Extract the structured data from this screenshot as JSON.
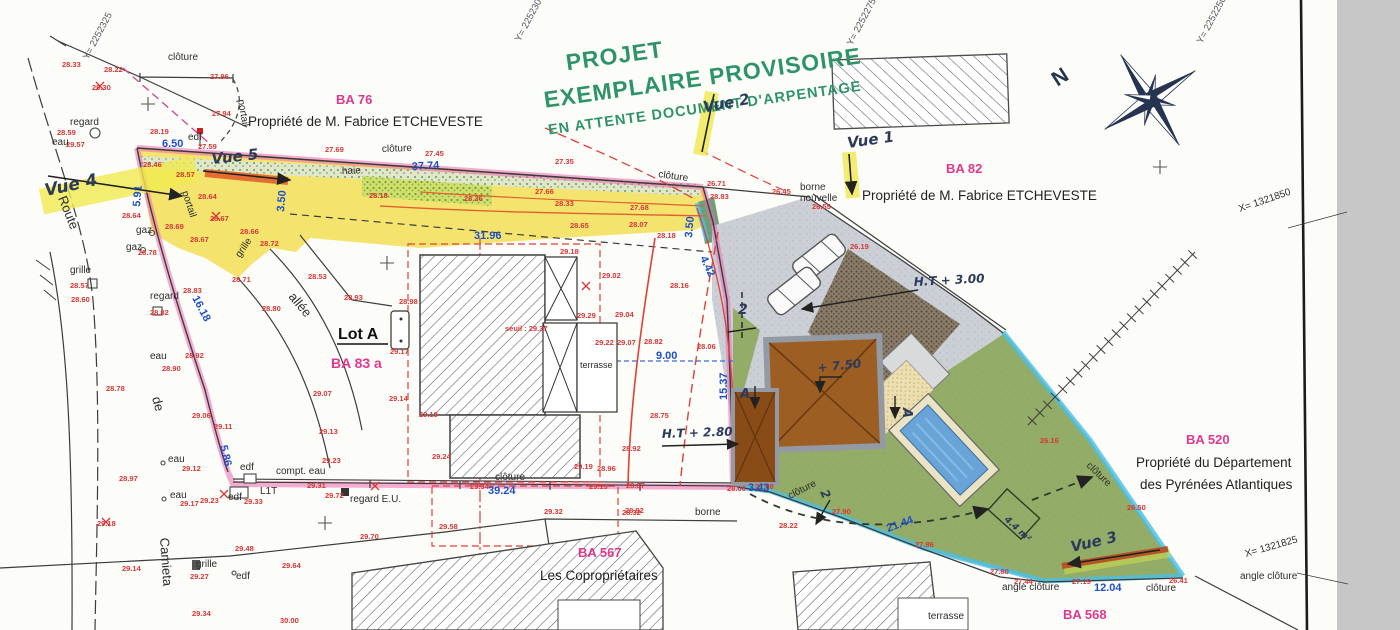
{
  "header": {
    "title_line1": "PROJET",
    "title_line2": "EXEMPLAIRE PROVISOIRE",
    "title_line3": "EN ATTENTE DOCUMENT D'ARPENTAGE"
  },
  "parcels": [
    {
      "id": "BA 76",
      "owner": "Propriété de M. Fabrice ETCHEVESTE"
    },
    {
      "id": "BA 82",
      "owner": "Propriété de M. Fabrice ETCHEVESTE"
    },
    {
      "id": "BA 83 a",
      "owner": ""
    },
    {
      "id": "BA 520",
      "owner_line1": "Propriété du Département",
      "owner_line2": "des Pyrénées Atlantiques"
    },
    {
      "id": "BA 567",
      "owner": "Les Copropriétaires"
    },
    {
      "id": "BA 568",
      "owner": ""
    }
  ],
  "lot": {
    "label": "Lot A"
  },
  "compass": {
    "north_label": "N"
  },
  "grid_labels": [
    [
      "Y= 2252325",
      88,
      60,
      -62
    ],
    [
      "Y= 2252300",
      520,
      42,
      -62
    ],
    [
      "Y= 2252275",
      852,
      46,
      -62
    ],
    [
      "Y= 2252250",
      1202,
      44,
      -62
    ]
  ],
  "dimensions": [
    [
      "6.50",
      162,
      147,
      0
    ],
    [
      "5.91",
      140,
      207,
      -85
    ],
    [
      "3.50",
      284,
      212,
      -85
    ],
    [
      "3.50",
      692,
      238,
      -85
    ],
    [
      "37.74",
      412,
      170,
      -3
    ],
    [
      "31.96",
      474,
      239,
      0
    ],
    [
      "16.18",
      192,
      298,
      62
    ],
    [
      "5.86",
      220,
      446,
      77
    ],
    [
      "9.00",
      656,
      359,
      0
    ],
    [
      "15.37",
      727,
      400,
      -90
    ],
    [
      "4.42",
      700,
      258,
      65
    ],
    [
      "39.24",
      488,
      494,
      0
    ],
    [
      "3.43",
      748,
      491,
      0
    ],
    [
      "21.44",
      888,
      532,
      -20
    ],
    [
      "12.04",
      1094,
      591,
      0
    ]
  ],
  "spot_elevations": [
    [
      "28.33",
      62,
      67
    ],
    [
      "28.22",
      104,
      72
    ],
    [
      "29.30",
      92,
      90
    ],
    [
      "27.96",
      210,
      79
    ],
    [
      "27.94",
      212,
      116
    ],
    [
      "28.19",
      150,
      134
    ],
    [
      "27.59",
      198,
      149
    ],
    [
      "28.59",
      57,
      135
    ],
    [
      "29.57",
      66,
      147
    ],
    [
      "28.46",
      143,
      167
    ],
    [
      "28.57",
      176,
      177
    ],
    [
      "28.64",
      198,
      199
    ],
    [
      "28.64",
      122,
      218
    ],
    [
      "28.67",
      210,
      221
    ],
    [
      "28.69",
      165,
      229
    ],
    [
      "28.67",
      190,
      242
    ],
    [
      "28.66",
      240,
      234
    ],
    [
      "28.72",
      260,
      246
    ],
    [
      "28.78",
      138,
      255
    ],
    [
      "28.57",
      70,
      288
    ],
    [
      "28.60",
      71,
      302
    ],
    [
      "28.71",
      232,
      282
    ],
    [
      "28.53",
      308,
      279
    ],
    [
      "28.83",
      183,
      293
    ],
    [
      "28.80",
      262,
      311
    ],
    [
      "28.82",
      150,
      315
    ],
    [
      "28.92",
      185,
      358
    ],
    [
      "28.90",
      162,
      371
    ],
    [
      "28.78",
      106,
      391
    ],
    [
      "29.06",
      192,
      418
    ],
    [
      "29.11",
      214,
      429
    ],
    [
      "29.07",
      313,
      396
    ],
    [
      "28.97",
      119,
      481
    ],
    [
      "29.12",
      182,
      471
    ],
    [
      "29.17",
      180,
      506
    ],
    [
      "29.23",
      200,
      503
    ],
    [
      "29.33",
      244,
      504
    ],
    [
      "29.31",
      307,
      488
    ],
    [
      "29.72",
      325,
      498
    ],
    [
      "29.13",
      319,
      434
    ],
    [
      "29.23",
      322,
      463
    ],
    [
      "29.14",
      122,
      571
    ],
    [
      "29.18",
      97,
      526
    ],
    [
      "29.48",
      235,
      551
    ],
    [
      "29.27",
      190,
      579
    ],
    [
      "29.34",
      192,
      616
    ],
    [
      "29.64",
      282,
      568
    ],
    [
      "30.00",
      280,
      623
    ],
    [
      "29.70",
      360,
      539
    ],
    [
      "29.58",
      439,
      529
    ],
    [
      "29.32",
      544,
      514
    ],
    [
      "28.32",
      622,
      515
    ],
    [
      "29.24",
      432,
      459
    ],
    [
      "29.34",
      470,
      489
    ],
    [
      "29.19",
      574,
      469
    ],
    [
      "28.96",
      597,
      471
    ],
    [
      "29.19",
      589,
      489
    ],
    [
      "28.93",
      344,
      300
    ],
    [
      "28.98",
      399,
      304
    ],
    [
      "29.17",
      390,
      354
    ],
    [
      "29.14",
      389,
      401
    ],
    [
      "29.19",
      419,
      417
    ],
    [
      "29.18",
      560,
      254
    ],
    [
      "29.02",
      602,
      278
    ],
    [
      "29.29",
      577,
      318
    ],
    [
      "29.04",
      615,
      317
    ],
    [
      "29.22",
      595,
      345
    ],
    [
      "29.07",
      617,
      345
    ],
    [
      "28.82",
      644,
      344
    ],
    [
      "28.06",
      697,
      349
    ],
    [
      "28.75",
      650,
      418
    ],
    [
      "28.92",
      622,
      451
    ],
    [
      "28.87",
      626,
      488
    ],
    [
      "28.92",
      625,
      513
    ],
    [
      "28.06",
      727,
      491
    ],
    [
      "27.98",
      755,
      489
    ],
    [
      "27.90",
      832,
      514
    ],
    [
      "28.22",
      779,
      528
    ],
    [
      "27.86",
      915,
      547
    ],
    [
      "27.80",
      990,
      574
    ],
    [
      "27.44",
      1014,
      584
    ],
    [
      "26.50",
      1127,
      510
    ],
    [
      "26.16",
      1040,
      443
    ],
    [
      "27.19",
      1072,
      584
    ],
    [
      "26.41",
      1169,
      583
    ],
    [
      "26.71",
      707,
      186
    ],
    [
      "28.83",
      710,
      199
    ],
    [
      "26.45",
      772,
      194
    ],
    [
      "26.55",
      812,
      209
    ],
    [
      "26.19",
      850,
      249
    ],
    [
      "28.18",
      657,
      238
    ],
    [
      "28.16",
      670,
      288
    ],
    [
      "27.69",
      325,
      152
    ],
    [
      "27.45",
      425,
      156
    ],
    [
      "27.35",
      555,
      164
    ],
    [
      "28.18",
      369,
      198
    ],
    [
      "28.36",
      464,
      201
    ],
    [
      "27.66",
      535,
      194
    ],
    [
      "28.33",
      555,
      206
    ],
    [
      "27.68",
      630,
      210
    ],
    [
      "28.65",
      570,
      228
    ],
    [
      "28.07",
      629,
      227
    ],
    [
      "seuil : 29.37",
      505,
      331
    ]
  ],
  "feature_labels": [
    [
      "clôture",
      168,
      60
    ],
    [
      "portail",
      238,
      100,
      80
    ],
    [
      "edf",
      188,
      140
    ],
    [
      "regard",
      70,
      125
    ],
    [
      "eau",
      52,
      145
    ],
    [
      "portail",
      182,
      192,
      72
    ],
    [
      "gaz",
      136,
      233
    ],
    [
      "gaz",
      126,
      250
    ],
    [
      "grille",
      70,
      273
    ],
    [
      "regard",
      150,
      299
    ],
    [
      "grille",
      240,
      258,
      -55
    ],
    [
      "Route",
      58,
      198,
      68,
      13
    ],
    [
      "de",
      152,
      398,
      75,
      13
    ],
    [
      "Camieta",
      160,
      538,
      86,
      13
    ],
    [
      "allée",
      288,
      297,
      50,
      13
    ],
    [
      "eau",
      150,
      359
    ],
    [
      "eau",
      168,
      462
    ],
    [
      "eau",
      170,
      498
    ],
    [
      "edf",
      240,
      470
    ],
    [
      "edf",
      228,
      500
    ],
    [
      "compt. eau",
      276,
      474
    ],
    [
      "L1T",
      260,
      494
    ],
    [
      "regard E.U.",
      350,
      502
    ],
    [
      "grille",
      196,
      567
    ],
    [
      "edf",
      236,
      579
    ],
    [
      "clôture",
      382,
      152,
      -2
    ],
    [
      "haie",
      342,
      174,
      -2
    ],
    [
      "clôture",
      658,
      177,
      8
    ],
    [
      "borne",
      800,
      190
    ],
    [
      "nouvelle",
      800,
      201
    ],
    [
      "clôture",
      495,
      480
    ],
    [
      "clôture",
      790,
      499,
      -27
    ],
    [
      "borne",
      695,
      515
    ],
    [
      "terrasse",
      580,
      368,
      0,
      9
    ],
    [
      "terrasse",
      928,
      619
    ],
    [
      "clôture",
      1086,
      466,
      44
    ],
    [
      "angle clôture",
      1002,
      590
    ],
    [
      "clôture",
      1146,
      591
    ],
    [
      "angle clôture",
      1240,
      579
    ],
    [
      "X= 1321850",
      1240,
      212,
      -19
    ],
    [
      "X= 1321825",
      1246,
      557,
      -16
    ]
  ],
  "handwritten": [
    [
      "Vue 4",
      46,
      196,
      -12,
      17
    ],
    [
      "Vue 5",
      212,
      164,
      -6,
      15
    ],
    [
      "Vue 2",
      704,
      112,
      -10,
      15
    ],
    [
      "Vue 1",
      848,
      148,
      -8,
      15
    ],
    [
      "Vue 3",
      1072,
      552,
      -13,
      15
    ],
    [
      "H.T + 2.80",
      662,
      438,
      -2,
      12
    ],
    [
      "H.T + 3.00",
      914,
      286,
      -3,
      12
    ],
    [
      "+ 7.50",
      818,
      372,
      -6,
      12
    ],
    [
      "A",
      740,
      398,
      0,
      13
    ],
    [
      "A",
      903,
      408,
      90,
      13
    ],
    [
      "2",
      738,
      314,
      0,
      14
    ],
    [
      "2",
      820,
      492,
      65,
      12
    ],
    [
      "4.4 m²",
      1004,
      520,
      43,
      9
    ]
  ],
  "colors": {
    "title_green": "#2e9468",
    "parcel_pink": "#e0388e",
    "elevation_red": "#d93636",
    "dimension_blue": "#2050c8",
    "parcel_yellow": "#f2e05a",
    "boundary_pink": "#ef6ab0",
    "boundary_cyan": "#49c0e8",
    "lawn_green": "#93ad68",
    "pool_blue": "#68a4d8",
    "roof_brown": "#9c5e22"
  }
}
